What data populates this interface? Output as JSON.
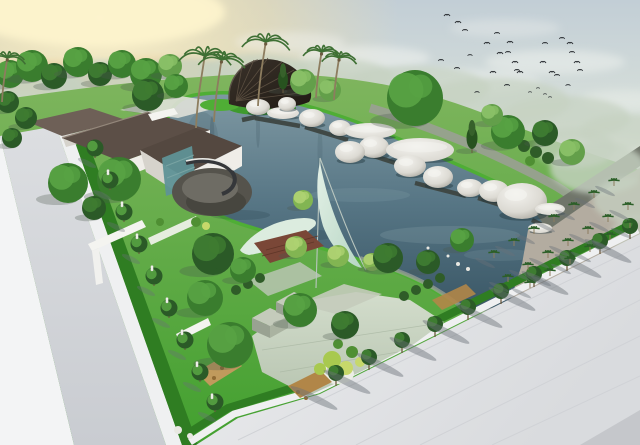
{
  "palette": {
    "skyTop": "#c2ced6",
    "skyMid": "#d8e0da",
    "skyLow": "#edecdc",
    "sunCore": "#fdf3cc",
    "sunGlow": "#f5e0a4",
    "cloudWarm": "#ecc386",
    "cloudWhite": "#f4f6f2",
    "hazeTree": "#c6d2c2",
    "bird": "#2e3236",
    "landTop": "#7fb55e",
    "landLow": "#42a02f",
    "grassBright": "#4fae35",
    "grassMid": "#3f9a2e",
    "grassDark": "#2f7d22",
    "waterTop": "#7e98a2",
    "waterMid": "#577685",
    "waterDeep": "#3a5766",
    "reflDark": "#1f3640",
    "reflLight": "#9db3ba",
    "pathGray": "#9aa094",
    "stoneRim": "#9aa296",
    "gravel": "#b3aca0",
    "pathDark": "#70756a",
    "offWhite": "#f3f4f5",
    "roadHi": "#dcdee1",
    "roadLo": "#c9ccd1",
    "curbWhite": "#eff0f1",
    "sidewalkHi": "#ebecee",
    "sidewalkLo": "#d9dbde",
    "sidewalkLine": "#d0d2d6",
    "roadDark": "#c5c7cb",
    "shadow": "#6a7078",
    "treeShadow": "#4c5a50",
    "roofA": "#6e6057",
    "roofB": "#5c4f47",
    "roofC": "#544840",
    "ridge": "#93867a",
    "wall": "#efede8",
    "wallShade": "#d6d3cc",
    "wallWhite": "#f4f4f0",
    "lightPath": "#dfe0d8",
    "glass": "#7fa9a8",
    "glassDark": "#5f9296",
    "deckFloor": "#55534c",
    "deckInner": "#6e6c64",
    "deckRim": "#47463f",
    "deckWallS": "#35373a",
    "deckTrim": "#e8e8e4",
    "shellHi": "#3a322a",
    "shellLo": "#201a14",
    "shellRib": "#5a4e40",
    "shellRim": "#5c5248",
    "pebbleHi": "#f4f3ef",
    "pebbleMid": "#dcdad3",
    "pebbleLo": "#a29f96",
    "pebbleShadow": "#22383f",
    "walkway": "#3e4642",
    "mast": "#b9c6bf",
    "sailHi": "#e3f0e6",
    "sailLo": "#b6d6c4",
    "sailL": "#dcecdf",
    "deckBrown": "#7a4737",
    "deckStep": "#5f3628",
    "plazaHi": "#d3ddcc",
    "plazaLo": "#b8c5b1",
    "plazaLine": "#aab8a4",
    "dishWhite": "#eceee6",
    "dishShade": "#c6cabd",
    "stoneTop": "#c4cbbb",
    "stoneSideL": "#99a292",
    "stoneSideR": "#aab3a1",
    "bedTan": "#c09a5c",
    "bedTan2": "#b18648",
    "trunk": "#6b5a3f",
    "palmTrunk": "#8d7d5f",
    "palm": "#3f7034",
    "gridPalm": "#2c5f28",
    "statue": "#f1f1ec",
    "statueEdge": "#b9b9b2",
    "treeTones": {
      "dark": {
        "b": "#2b5a27",
        "h": "#3e7c31"
      },
      "mid": {
        "b": "#3a7d2e",
        "h": "#57a243"
      },
      "light": {
        "b": "#639f4a",
        "h": "#8ac167"
      },
      "lime": {
        "b": "#82b552",
        "h": "#aed272"
      },
      "conifer": {
        "b": "#27521f",
        "h": "#37612b"
      }
    },
    "shrubC": {
      "lime1": "#a8c94f",
      "lime2": "#c6d86a",
      "grn": "#4f8f33",
      "dk": "#2f5c28",
      "dot": "#8f6a33",
      "rock": "#e8e8e2"
    }
  },
  "scene": {
    "clouds": [
      [
        95,
        12,
        130,
        34,
        "sunCore",
        0.95
      ],
      [
        45,
        78,
        70,
        16,
        "cloudWarm",
        0.55
      ],
      [
        125,
        96,
        85,
        18,
        "cloudWarm",
        0.5
      ],
      [
        205,
        112,
        75,
        14,
        "cloudWarm",
        0.42
      ],
      [
        65,
        122,
        55,
        12,
        "cloudWarm",
        0.38
      ],
      [
        160,
        70,
        60,
        13,
        "cloudWarm",
        0.35
      ],
      [
        290,
        42,
        55,
        10,
        "cloudWhite",
        0.4
      ],
      [
        365,
        58,
        65,
        12,
        "cloudWhite",
        0.5
      ],
      [
        455,
        82,
        85,
        13,
        "cloudWhite",
        0.42
      ],
      [
        555,
        62,
        70,
        12,
        "cloudWhite",
        0.45
      ],
      [
        625,
        100,
        45,
        10,
        "cloudWhite",
        0.35
      ],
      [
        505,
        28,
        55,
        9,
        "cloudWhite",
        0.3
      ],
      [
        600,
        145,
        55,
        9,
        "cloudWhite",
        0.3
      ]
    ],
    "haze": [
      [
        30,
        88,
        55,
        22,
        0.85
      ],
      [
        105,
        82,
        65,
        22,
        0.8
      ],
      [
        185,
        78,
        55,
        20,
        0.75
      ],
      [
        255,
        72,
        55,
        18,
        0.7
      ],
      [
        330,
        78,
        65,
        20,
        0.7
      ],
      [
        415,
        88,
        75,
        22,
        0.7
      ],
      [
        495,
        102,
        75,
        24,
        0.7
      ],
      [
        565,
        118,
        65,
        22,
        0.7
      ],
      [
        625,
        132,
        45,
        18,
        0.7
      ],
      [
        0,
        120,
        40,
        18,
        0.6
      ]
    ],
    "hazeRight": [
      [
        598,
        168,
        48,
        26,
        0.8
      ],
      [
        628,
        200,
        35,
        22,
        0.7
      ],
      [
        575,
        148,
        40,
        20,
        0.7
      ],
      [
        638,
        235,
        28,
        20,
        0.55
      ]
    ],
    "birds": [
      [
        447,
        15,
        1
      ],
      [
        458,
        22,
        1
      ],
      [
        465,
        30,
        0.9
      ],
      [
        487,
        43,
        1
      ],
      [
        497,
        33,
        0.9
      ],
      [
        500,
        53,
        1
      ],
      [
        508,
        52,
        0.9
      ],
      [
        510,
        42,
        1
      ],
      [
        515,
        62,
        1
      ],
      [
        517,
        70,
        0.9
      ],
      [
        520,
        72,
        1
      ],
      [
        545,
        43,
        0.9
      ],
      [
        543,
        62,
        1
      ],
      [
        552,
        72,
        1
      ],
      [
        557,
        75,
        0.9
      ],
      [
        562,
        38,
        0.9
      ],
      [
        570,
        43,
        1
      ],
      [
        572,
        52,
        0.9
      ],
      [
        577,
        62,
        1
      ],
      [
        580,
        70,
        0.9
      ],
      [
        457,
        68,
        0.9
      ],
      [
        493,
        72,
        1
      ],
      [
        507,
        85,
        0.9
      ],
      [
        477,
        92,
        0.8
      ],
      [
        568,
        85,
        0.8
      ],
      [
        530,
        92,
        0.6
      ],
      [
        538,
        88,
        0.6
      ],
      [
        545,
        94,
        0.6
      ],
      [
        550,
        97,
        0.6
      ],
      [
        441,
        60,
        0.9
      ],
      [
        470,
        55,
        0.8
      ]
    ],
    "trees": [
      [
        10,
        74,
        14,
        "mid"
      ],
      [
        32,
        66,
        16,
        "mid"
      ],
      [
        54,
        76,
        13,
        "dark"
      ],
      [
        78,
        62,
        15,
        "mid"
      ],
      [
        100,
        74,
        12,
        "dark"
      ],
      [
        122,
        64,
        14,
        "mid"
      ],
      [
        146,
        74,
        16,
        "mid"
      ],
      [
        170,
        66,
        12,
        "light"
      ],
      [
        8,
        102,
        11,
        "dark"
      ],
      [
        26,
        118,
        11,
        "dark"
      ],
      [
        12,
        138,
        10,
        "dark"
      ],
      [
        148,
        95,
        16,
        "dark"
      ],
      [
        176,
        86,
        12,
        "mid"
      ],
      [
        303,
        82,
        13,
        "light"
      ],
      [
        283,
        84,
        9,
        "conifer"
      ],
      [
        330,
        90,
        11,
        "light"
      ],
      [
        415,
        98,
        28,
        "mid"
      ],
      [
        472,
        143,
        10,
        "conifer"
      ],
      [
        508,
        132,
        17,
        "mid"
      ],
      [
        545,
        133,
        13,
        "dark"
      ],
      [
        492,
        115,
        11,
        "light"
      ],
      [
        572,
        152,
        13,
        "light"
      ],
      [
        68,
        183,
        20,
        "mid"
      ],
      [
        119,
        179,
        22,
        "mid"
      ],
      [
        94,
        208,
        12,
        "dark"
      ],
      [
        213,
        254,
        21,
        "dark"
      ],
      [
        243,
        270,
        13,
        "mid"
      ],
      [
        205,
        298,
        18,
        "mid"
      ],
      [
        230,
        345,
        23,
        "mid"
      ],
      [
        300,
        310,
        17,
        "mid"
      ],
      [
        345,
        325,
        14,
        "dark"
      ],
      [
        303,
        200,
        10,
        "lime"
      ],
      [
        296,
        247,
        11,
        "lime"
      ],
      [
        338,
        256,
        11,
        "lime"
      ],
      [
        372,
        262,
        9,
        "lime"
      ],
      [
        388,
        258,
        15,
        "dark"
      ],
      [
        428,
        262,
        12,
        "dark"
      ],
      [
        462,
        240,
        12,
        "mid"
      ]
    ],
    "palms": [
      [
        196,
        128,
        72
      ],
      [
        214,
        122,
        62
      ],
      [
        258,
        106,
        64
      ],
      [
        316,
        98,
        46
      ],
      [
        334,
        100,
        42
      ],
      [
        2,
        102,
        44
      ]
    ],
    "leftTrees": [
      [
        95,
        158
      ],
      [
        110,
        190
      ],
      [
        124,
        222
      ],
      [
        139,
        254
      ],
      [
        154,
        286
      ],
      [
        169,
        318
      ],
      [
        185,
        350
      ],
      [
        200,
        382
      ],
      [
        215,
        412
      ]
    ],
    "statues": [
      [
        108,
        175
      ],
      [
        122,
        207
      ],
      [
        137,
        239
      ],
      [
        152,
        271
      ],
      [
        167,
        303
      ],
      [
        182,
        335
      ],
      [
        197,
        367
      ],
      [
        212,
        399
      ]
    ],
    "streetTrees": [
      [
        336,
        386
      ],
      [
        369,
        370
      ],
      [
        402,
        353
      ],
      [
        435,
        337
      ],
      [
        468,
        320
      ],
      [
        501,
        304
      ],
      [
        534,
        287
      ],
      [
        567,
        271
      ],
      [
        600,
        254
      ],
      [
        630,
        239
      ]
    ],
    "gridPalms": [
      [
        494,
        258
      ],
      [
        514,
        246
      ],
      [
        534,
        234
      ],
      [
        554,
        222
      ],
      [
        574,
        210
      ],
      [
        594,
        198
      ],
      [
        614,
        186
      ],
      [
        508,
        282
      ],
      [
        528,
        270
      ],
      [
        548,
        258
      ],
      [
        568,
        246
      ],
      [
        588,
        234
      ],
      [
        608,
        222
      ],
      [
        628,
        210
      ],
      [
        530,
        288
      ],
      [
        550,
        276
      ],
      [
        570,
        264
      ],
      [
        590,
        252
      ],
      [
        610,
        240
      ],
      [
        630,
        228
      ]
    ],
    "pebbles": [
      [
        258,
        107,
        12,
        8,
        "dome"
      ],
      [
        283,
        113,
        16,
        6,
        "disc"
      ],
      [
        287,
        104,
        9,
        7,
        "dome"
      ],
      [
        312,
        118,
        13,
        9,
        "dome"
      ],
      [
        340,
        128,
        11,
        8,
        "dome"
      ],
      [
        370,
        131,
        26,
        8,
        "disc"
      ],
      [
        374,
        147,
        15,
        11,
        "dome"
      ],
      [
        350,
        152,
        15,
        11,
        "dome"
      ],
      [
        420,
        150,
        34,
        12,
        "disc"
      ],
      [
        410,
        166,
        16,
        11,
        "dome"
      ],
      [
        438,
        177,
        15,
        11,
        "dome"
      ],
      [
        470,
        188,
        13,
        9,
        "dome"
      ],
      [
        494,
        191,
        15,
        11,
        "dome"
      ],
      [
        522,
        201,
        25,
        18,
        "dome"
      ],
      [
        550,
        209,
        15,
        6,
        "disc"
      ],
      [
        540,
        228,
        12,
        5,
        "disc"
      ]
    ],
    "walkways": [
      [
        242,
        120,
        256,
        117
      ],
      [
        255,
        118,
        300,
        126
      ],
      [
        305,
        127,
        348,
        140
      ],
      [
        355,
        150,
        408,
        167
      ],
      [
        415,
        183,
        466,
        196
      ],
      [
        478,
        198,
        510,
        208
      ],
      [
        532,
        220,
        548,
        228
      ]
    ],
    "shrubs": [
      [
        332,
        360,
        9,
        "lime1"
      ],
      [
        346,
        368,
        7,
        "lime2"
      ],
      [
        320,
        369,
        6,
        "lime1"
      ],
      [
        352,
        352,
        6,
        "grn"
      ],
      [
        338,
        344,
        5,
        "grn"
      ],
      [
        360,
        362,
        5,
        "lime2"
      ],
      [
        404,
        296,
        5,
        "dk"
      ],
      [
        416,
        290,
        5,
        "dk"
      ],
      [
        428,
        284,
        5,
        "dk"
      ],
      [
        440,
        278,
        5,
        "dk"
      ],
      [
        236,
        290,
        5,
        "dk"
      ],
      [
        248,
        284,
        5,
        "dk"
      ],
      [
        260,
        278,
        5,
        "dk"
      ],
      [
        524,
        146,
        6,
        "dk"
      ],
      [
        536,
        152,
        6,
        "dk"
      ],
      [
        548,
        158,
        6,
        "dk"
      ],
      [
        530,
        161,
        5,
        "grn"
      ],
      [
        206,
        372,
        2,
        "dot"
      ],
      [
        214,
        378,
        2,
        "dot"
      ],
      [
        222,
        368,
        2,
        "dot"
      ],
      [
        298,
        392,
        2,
        "dot"
      ],
      [
        306,
        398,
        2,
        "dot"
      ],
      [
        178,
        430,
        4,
        "rock"
      ],
      [
        190,
        436,
        3,
        "rock"
      ],
      [
        458,
        264,
        2,
        "rock"
      ],
      [
        468,
        269,
        2,
        "rock"
      ],
      [
        448,
        256,
        1.5,
        "rock"
      ],
      [
        428,
        248,
        1.5,
        "rock"
      ],
      [
        196,
        222,
        5,
        "grn"
      ],
      [
        206,
        226,
        4,
        "lime2"
      ],
      [
        160,
        222,
        4,
        "grn"
      ]
    ],
    "reflections": [
      [
        212,
        142,
        2.5,
        26,
        0.18,
        "reflDark"
      ],
      [
        258,
        128,
        2,
        20,
        0.15,
        "reflDark"
      ],
      [
        320,
        150,
        2.5,
        22,
        0.12,
        "reflDark"
      ],
      [
        202,
        138,
        16,
        26,
        0.12,
        "reflDark"
      ],
      [
        450,
        235,
        70,
        9,
        0.2,
        "reflLight"
      ],
      [
        360,
        195,
        50,
        7,
        0.15,
        "reflLight"
      ],
      [
        500,
        255,
        36,
        6,
        0.15,
        "reflLight"
      ],
      [
        300,
        235,
        36,
        6,
        0.18,
        "reflDark"
      ],
      [
        240,
        215,
        30,
        5,
        0.2,
        "reflDark"
      ]
    ]
  }
}
